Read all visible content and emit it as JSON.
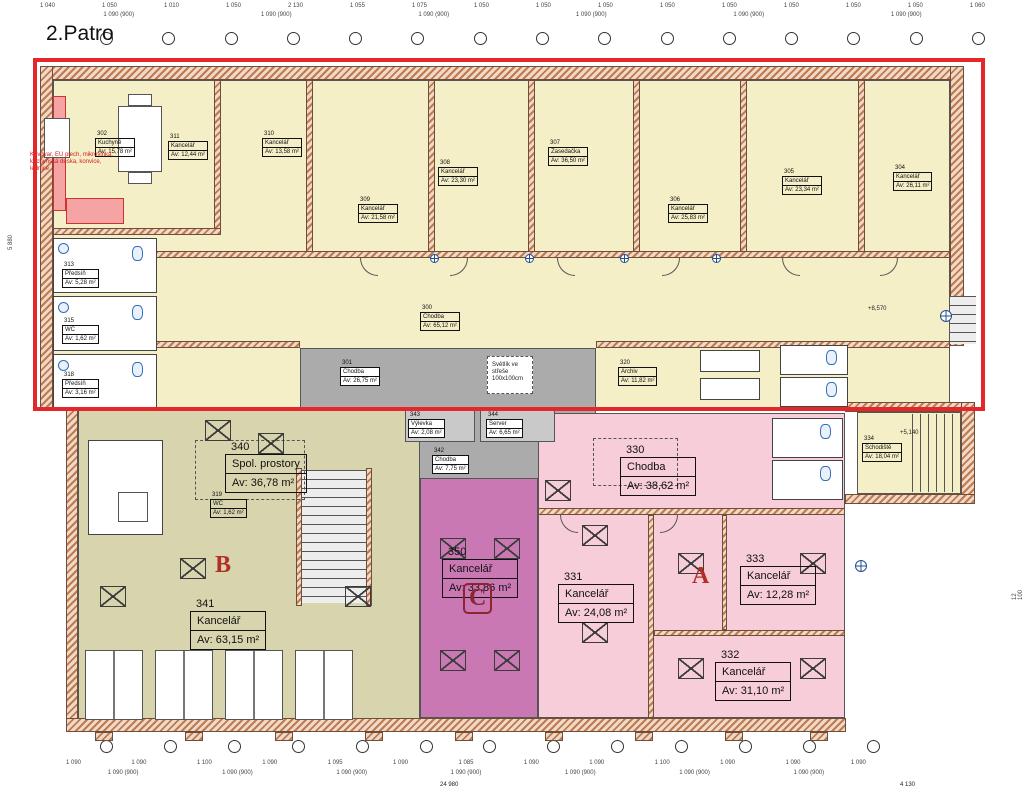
{
  "title": "2.Patro",
  "colors": {
    "highlight_red": "#e5262b",
    "upper_cream": "#f5efc8",
    "zone_b_olive": "#d8d5ae",
    "zone_c_magenta": "#c978b4",
    "zone_a_pink": "#f6cdd8",
    "service_gray": "#ababab",
    "wall_hatch": "#bf7a52",
    "fixture_blue": "#2f6fb8",
    "letter_red": "#b03028"
  },
  "zones": {
    "a": {
      "letter": "A"
    },
    "b": {
      "letter": "B"
    },
    "c": {
      "letter": "C"
    }
  },
  "rooms": {
    "r300": {
      "no": "300",
      "name": "Chodba",
      "area": "Av: 65,12 m²"
    },
    "r301": {
      "no": "301",
      "name": "Chodba",
      "area": "Av: 26,75 m²"
    },
    "r302": {
      "no": "302",
      "name": "Kuchyně",
      "area": "Av: 15,78 m²"
    },
    "r304": {
      "no": "304",
      "name": "Kancelář",
      "area": "Av: 26,11 m²"
    },
    "r305": {
      "no": "305",
      "name": "Kancelář",
      "area": "Av: 23,34 m²"
    },
    "r306": {
      "no": "306",
      "name": "Kancelář",
      "area": "Av: 25,83 m²"
    },
    "r307": {
      "no": "307",
      "name": "Zasedačka",
      "area": "Av: 36,50 m²"
    },
    "r308": {
      "no": "308",
      "name": "Kancelář",
      "area": "Av: 23,30 m²"
    },
    "r309": {
      "no": "309",
      "name": "Kancelář",
      "area": "Av: 21,58 m²"
    },
    "r310": {
      "no": "310",
      "name": "Kancelář",
      "area": "Av: 13,58 m²"
    },
    "r311": {
      "no": "311",
      "name": "Kancelář",
      "area": "Av: 12,44 m²"
    },
    "r313": {
      "no": "313",
      "name": "Předsíň",
      "area": "Av: 5,28 m²"
    },
    "r315": {
      "no": "315",
      "name": "WC",
      "area": "Av: 1,62 m²"
    },
    "r318": {
      "no": "318",
      "name": "Předsíň",
      "area": "Av: 3,16 m²"
    },
    "r319": {
      "no": "319",
      "name": "WC",
      "area": "Av: 1,62 m²"
    },
    "r320": {
      "no": "320",
      "name": "Archiv",
      "area": "Av: 11,82 m²"
    },
    "r330": {
      "no": "330",
      "name": "Chodba",
      "area": "Av: 38,62 m²"
    },
    "r331": {
      "no": "331",
      "name": "Kancelář",
      "area": "Av: 24,08 m²"
    },
    "r332": {
      "no": "332",
      "name": "Kancelář",
      "area": "Av: 31,10 m²"
    },
    "r333": {
      "no": "333",
      "name": "Kancelář",
      "area": "Av: 12,28 m²"
    },
    "r334": {
      "no": "334",
      "name": "Schodiště",
      "area": "Av: 18,04 m²"
    },
    "r340": {
      "no": "340",
      "name": "Spol. prostory",
      "area": "Av: 36,78 m²"
    },
    "r341": {
      "no": "341",
      "name": "Kancelář",
      "area": "Av: 63,15 m²"
    },
    "r342": {
      "no": "342",
      "name": "Chodba",
      "area": "Av: 7,75 m²"
    },
    "r343": {
      "no": "343",
      "name": "Výlevka",
      "area": "Av: 2,08 m²"
    },
    "r344": {
      "no": "344",
      "name": "Server",
      "area": "Av: 6,65 m²"
    },
    "r350": {
      "no": "350",
      "name": "Kancelář",
      "area": "Av: 33,86 m²"
    }
  },
  "annotations": {
    "kitchen_note": "Kávovar, EU plech, mikrovlnka,\nkuchyňská deska, konvice,\nlednice",
    "skylight_note": "Světlík ve\nstřeše\n100x100cm",
    "level_corridor": "+8,570",
    "level_stair": "+5,140"
  },
  "dims": {
    "top": [
      "1 040",
      "1 050",
      "1 010",
      "1 050",
      "2 130",
      "1 055",
      "1 075",
      "1 050",
      "1 050",
      "1 050",
      "1 050",
      "1 050",
      "1 050",
      "1 050",
      "1 050",
      "1 060"
    ],
    "top2": [
      "1 090 (900)",
      "1 090 (900)",
      "1 090 (900)",
      "1 090 (900)",
      "1 090 (900)",
      "1 090 (900)"
    ],
    "bottom1": [
      "1 090",
      "1 090",
      "1 100",
      "1 090",
      "1 095",
      "1 090",
      "1 085",
      "1 090",
      "1 090",
      "1 100",
      "1 090",
      "1 090",
      "1 090"
    ],
    "bottom2": [
      "1 090 (900)",
      "1 090 (900)",
      "1 090 (900)",
      "1 090 (900)",
      "1 090 (900)",
      "1 090 (900)",
      "1 090 (900)"
    ],
    "totals": {
      "bottom": "24 980",
      "bottom_right": "4 130",
      "left_vertical": "5 880",
      "right_vertical": "12 100"
    }
  }
}
